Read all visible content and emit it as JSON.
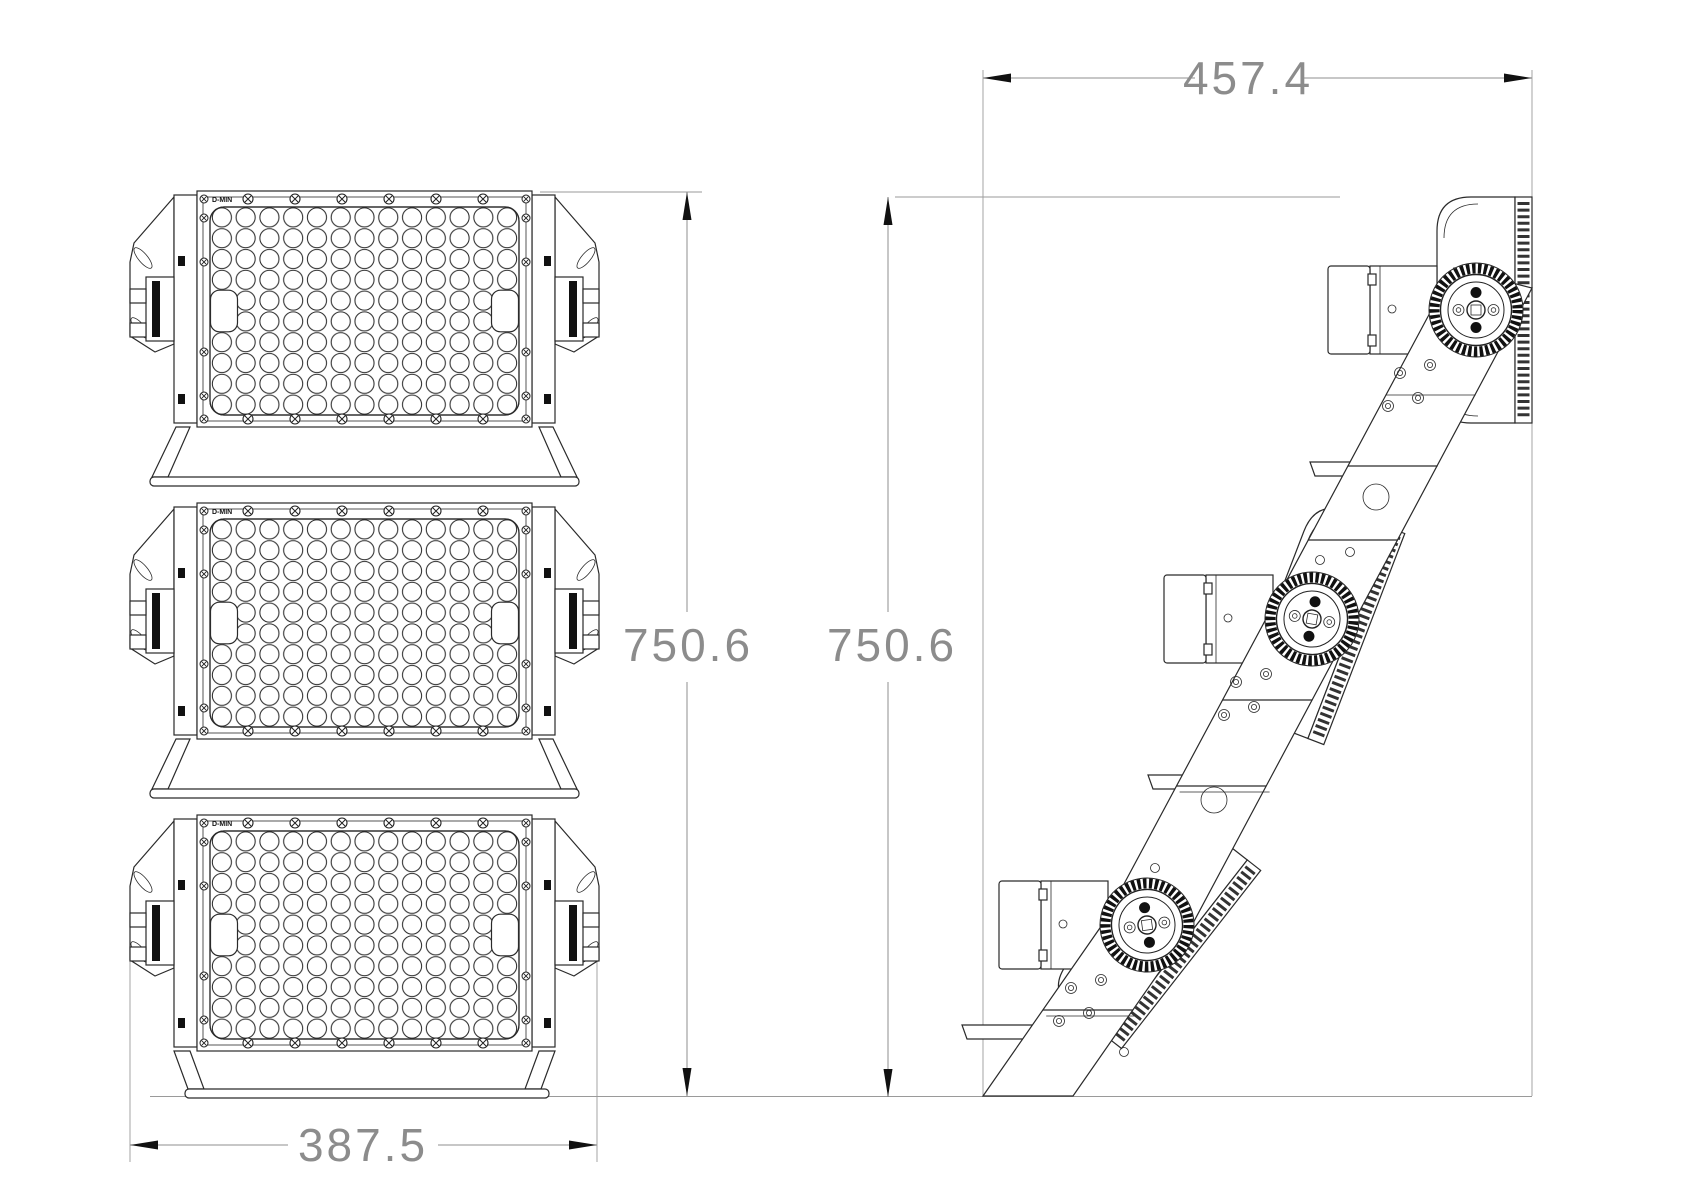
{
  "drawing": {
    "type": "technical-cad-drawing",
    "views": {
      "front_view": "three stacked LED flood light modules with lens grid",
      "side_view": "tilted modules on diagonal mounting arm with aiming gears"
    },
    "dimensions": {
      "side_width": {
        "value": "457.4"
      },
      "front_height": {
        "value": "750.6"
      },
      "side_height": {
        "value": "750.6"
      },
      "front_width": {
        "value": "387.5"
      }
    },
    "module": {
      "brand_label": "D-MIN"
    },
    "colors": {
      "line": "#2a2a2a",
      "dim_line": "#8f8f8f",
      "dim_text": "#8c8c8c",
      "arrow": "#111111",
      "background": "#ffffff"
    }
  }
}
